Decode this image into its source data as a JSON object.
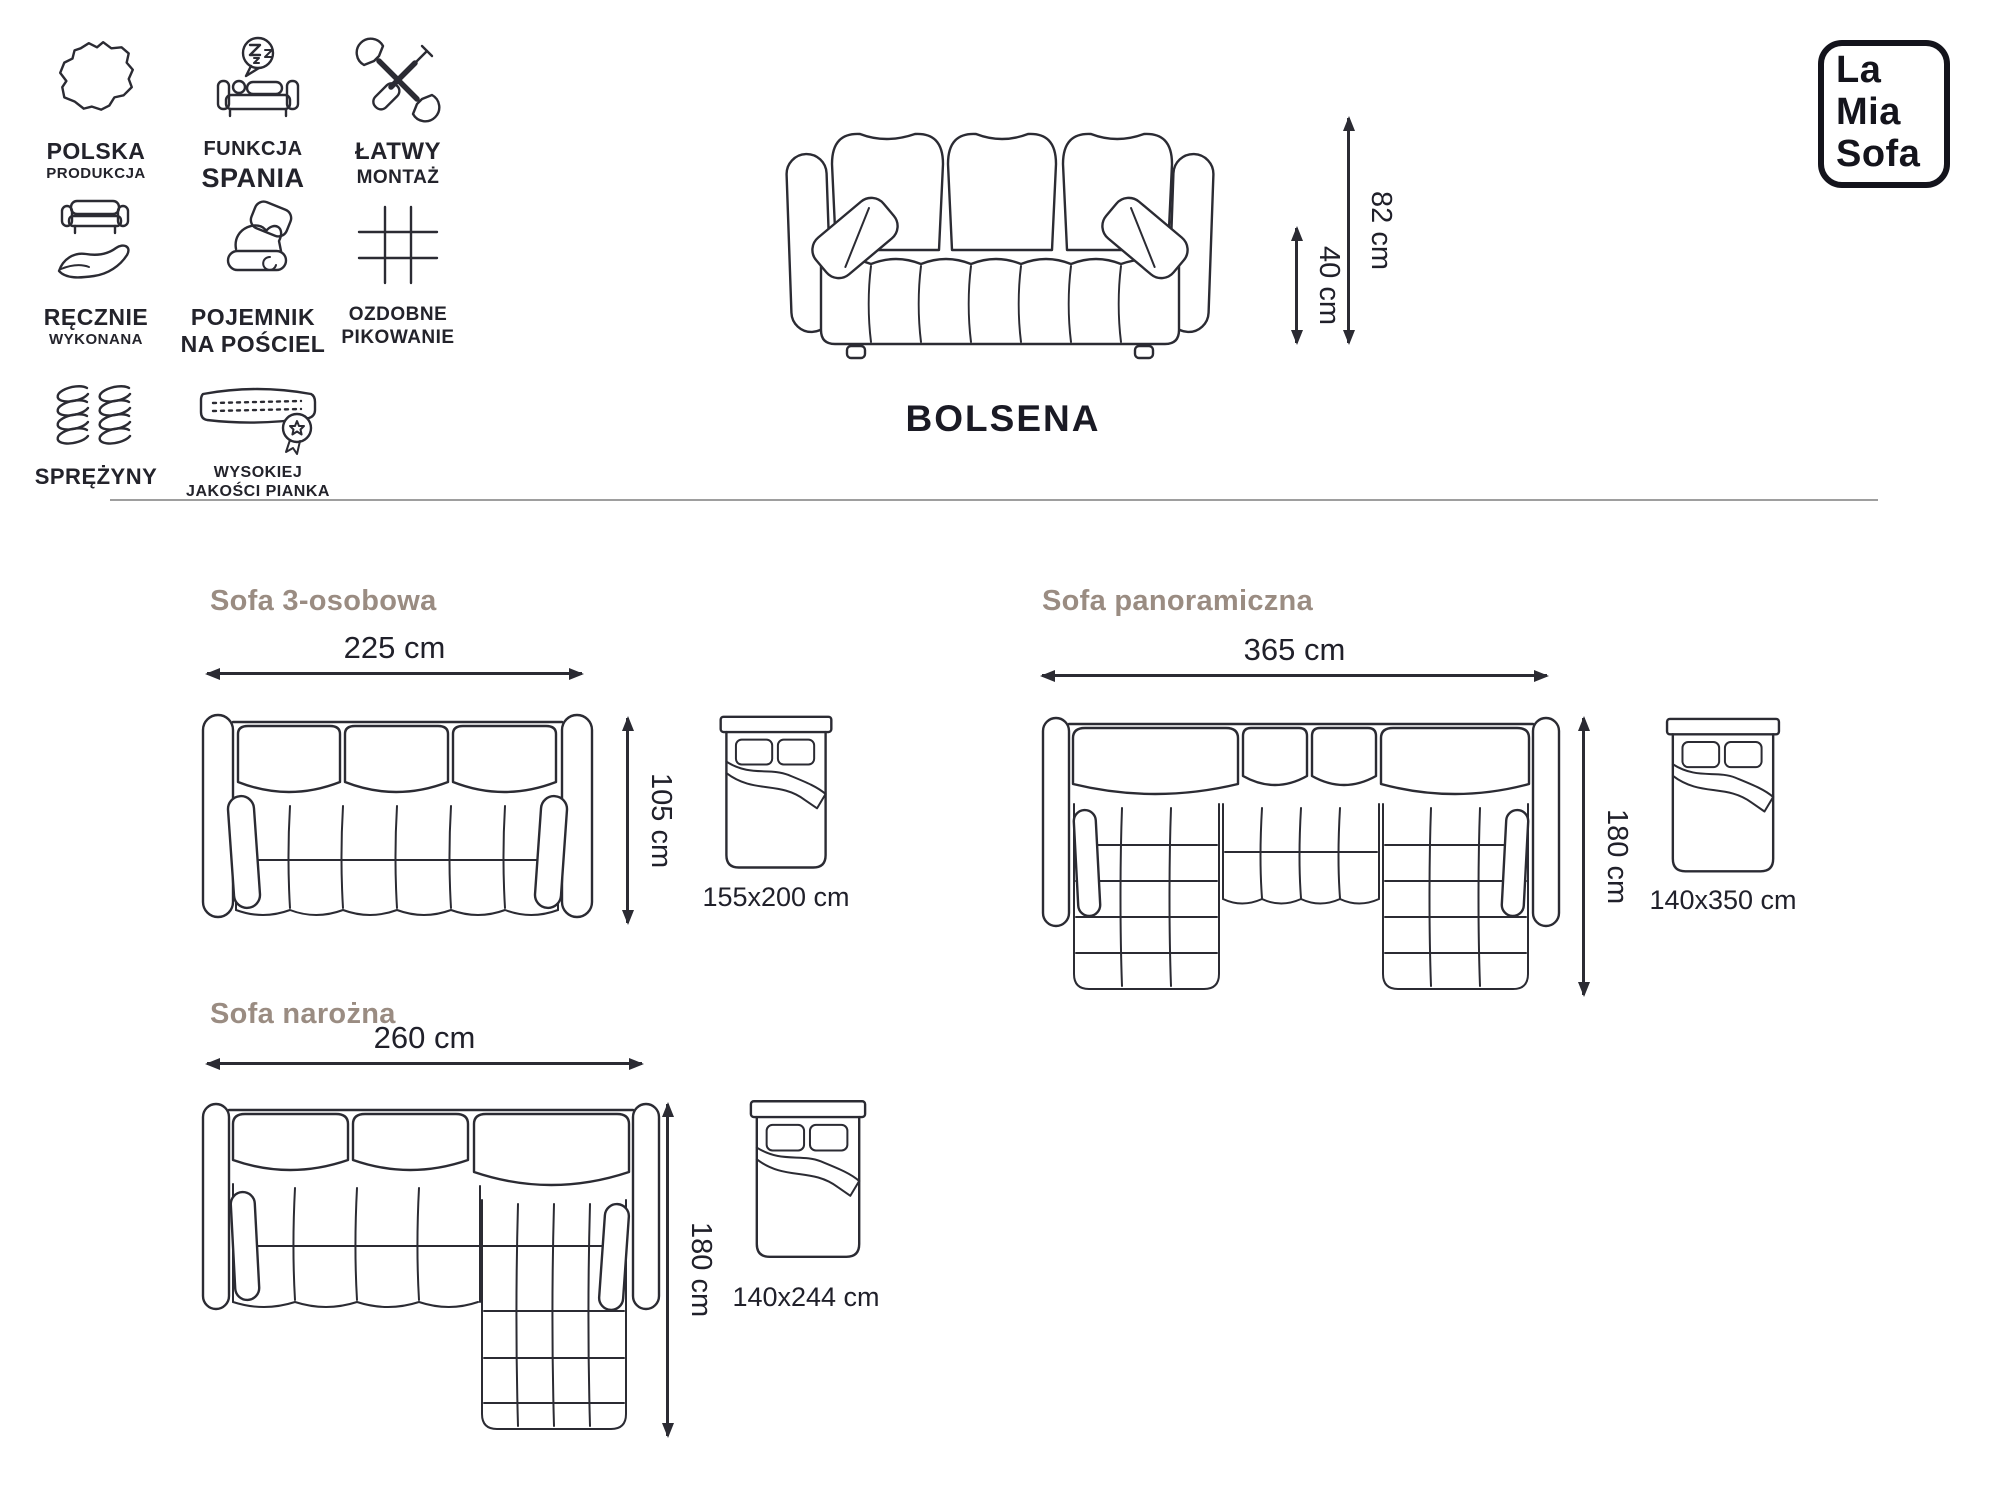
{
  "brand": {
    "logo_lines": [
      "La",
      "Mia",
      "Sofa"
    ]
  },
  "product": {
    "name": "BOLSENA"
  },
  "features": [
    {
      "icon": "poland-map-icon",
      "line1": "POLSKA",
      "line2": "PRODUKCJA"
    },
    {
      "icon": "sleep-function-icon",
      "line1": "FUNKCJA",
      "line2": "SPANIA"
    },
    {
      "icon": "easy-assembly-tools-icon",
      "line1": "ŁATWY",
      "line2": "MONTAŻ"
    },
    {
      "icon": "handmade-icon",
      "line1": "RĘCZNIE",
      "line2": "WYKONANA"
    },
    {
      "icon": "bedding-storage-icon",
      "line1": "POJEMNIK",
      "line2": "NA POŚCIEL"
    },
    {
      "icon": "quilting-grid-icon",
      "line1": "OZDOBNE",
      "line2": "PIKOWANIE"
    },
    {
      "icon": "springs-icon",
      "line1": "SPRĘŻYNY",
      "line2": ""
    },
    {
      "icon": "foam-quality-icon",
      "line1": "WYSOKIEJ",
      "line2": "JAKOŚCI PIANKA"
    }
  ],
  "front_view": {
    "height_total": "82 cm",
    "height_seat": "40 cm"
  },
  "variants": [
    {
      "title": "Sofa 3-osobowa",
      "width": "225 cm",
      "depth": "105 cm",
      "bed": "155x200 cm"
    },
    {
      "title": "Sofa panoramiczna",
      "width": "365 cm",
      "depth": "180 cm",
      "bed": "140x350 cm"
    },
    {
      "title": "Sofa narożna",
      "width": "260 cm",
      "depth": "180 cm",
      "bed": "140x244 cm"
    }
  ],
  "colors": {
    "line": "#2b2b33",
    "text": "#20202a",
    "heading": "#9a8c82",
    "divider": "#9e9e9e"
  }
}
